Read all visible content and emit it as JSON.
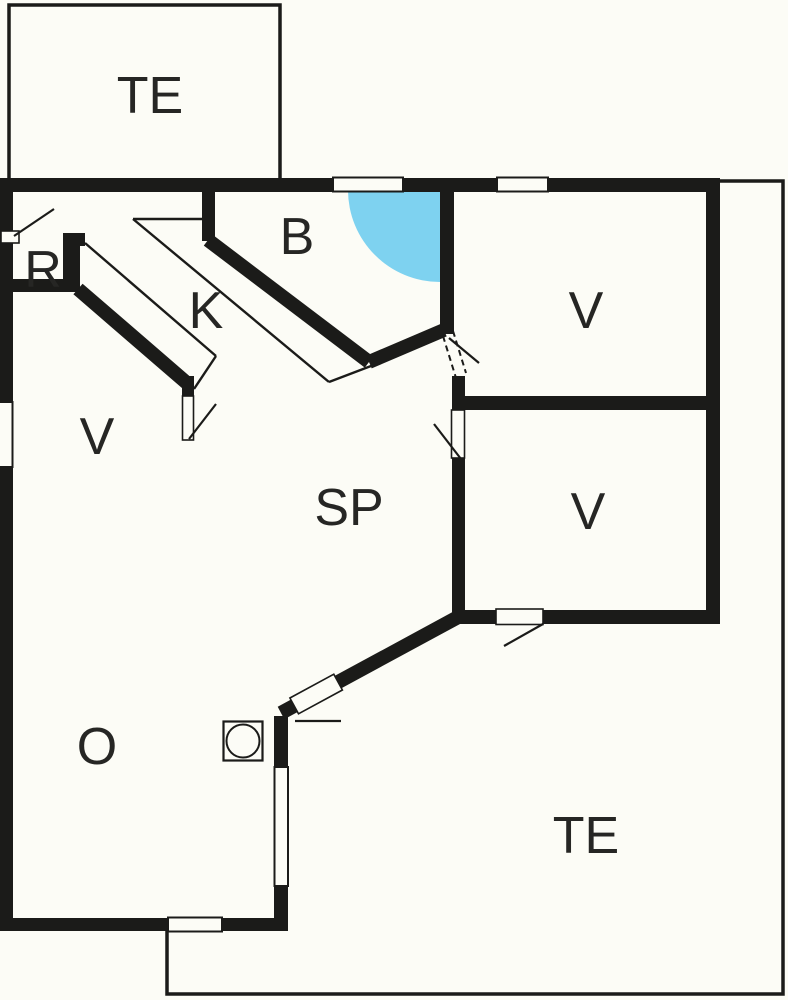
{
  "title": "Holiday house floor plan",
  "colors": {
    "background": "#fcfcf6",
    "wall": "#1b1b19",
    "shower_blue": "#7ed2f0",
    "label": "#262624"
  },
  "rooms": {
    "terrace_top": {
      "label": "TE"
    },
    "storage": {
      "label": "R"
    },
    "kitchen": {
      "label": "K"
    },
    "bathroom": {
      "label": "B"
    },
    "bedroom_left": {
      "label": "V"
    },
    "bedroom_top_right": {
      "label": "V"
    },
    "bedroom_mid_right": {
      "label": "V"
    },
    "living_room": {
      "label": "SP"
    },
    "utility_room": {
      "label": "O"
    },
    "terrace_bottom": {
      "label": "TE"
    }
  },
  "icons": {
    "washing_machine": "washing-machine-icon",
    "shower_corner": "shower-corner-icon"
  }
}
